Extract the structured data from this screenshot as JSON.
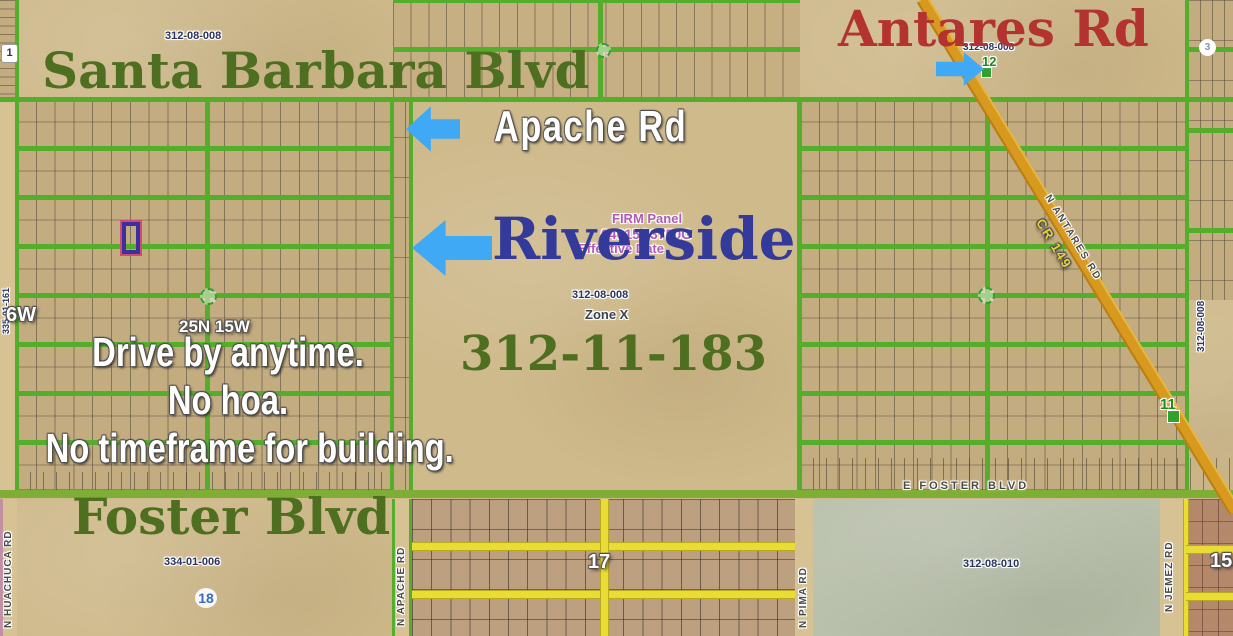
{
  "title_labels": {
    "santa_barbara": "Santa Barbara Blvd",
    "antares": "Antares Rd",
    "apache": "Apache Rd",
    "riverside": "Riverside",
    "foster": "Foster Blvd",
    "subject_apn": "312-11-183"
  },
  "marketing": {
    "line1": "Drive by anytime.",
    "line2": "No hoa.",
    "line3": "No timeframe for building."
  },
  "flood": {
    "firm_panel": "FIRM Panel",
    "firm_number": "04015C3750G",
    "firm_effective": "Effective Date",
    "zone": "Zone X"
  },
  "parcel_numbers": {
    "top_left": "312-08-008",
    "top_right": "312-08-008",
    "center": "312-08-008",
    "right_strip": "312-08-008",
    "left_strip": "335-01-161",
    "bottom_left": "334-01-006",
    "bottom_right": "312-08-010"
  },
  "street_labels": {
    "e_foster": "E FOSTER BLVD",
    "n_huachuca": "N HUACHUCA RD",
    "n_apache": "N APACHE RD",
    "n_pima": "N PIMA RD",
    "n_jemez": "N JEMEZ RD",
    "n_antares": "N ANTARES RD",
    "cr": "CR 149"
  },
  "section_numbers": {
    "s1": "1",
    "s3": "3",
    "s11": "11",
    "s12": "12",
    "s15": "15",
    "s17": "17",
    "s18": "18"
  },
  "township": {
    "township_range": "25N 15W",
    "range_partial": "6W"
  },
  "colors": {
    "arrow_blue": "#3fa9f5",
    "road_green": "#55ad2c",
    "road_yellow": "#e8dc35",
    "road_orange": "#d79a1f",
    "text_green": "#4e6e20",
    "text_red": "#b23330",
    "text_navy": "#333a99",
    "text_purple": "#b35ab3",
    "subject_marker_purple": "#3d2f9f"
  }
}
